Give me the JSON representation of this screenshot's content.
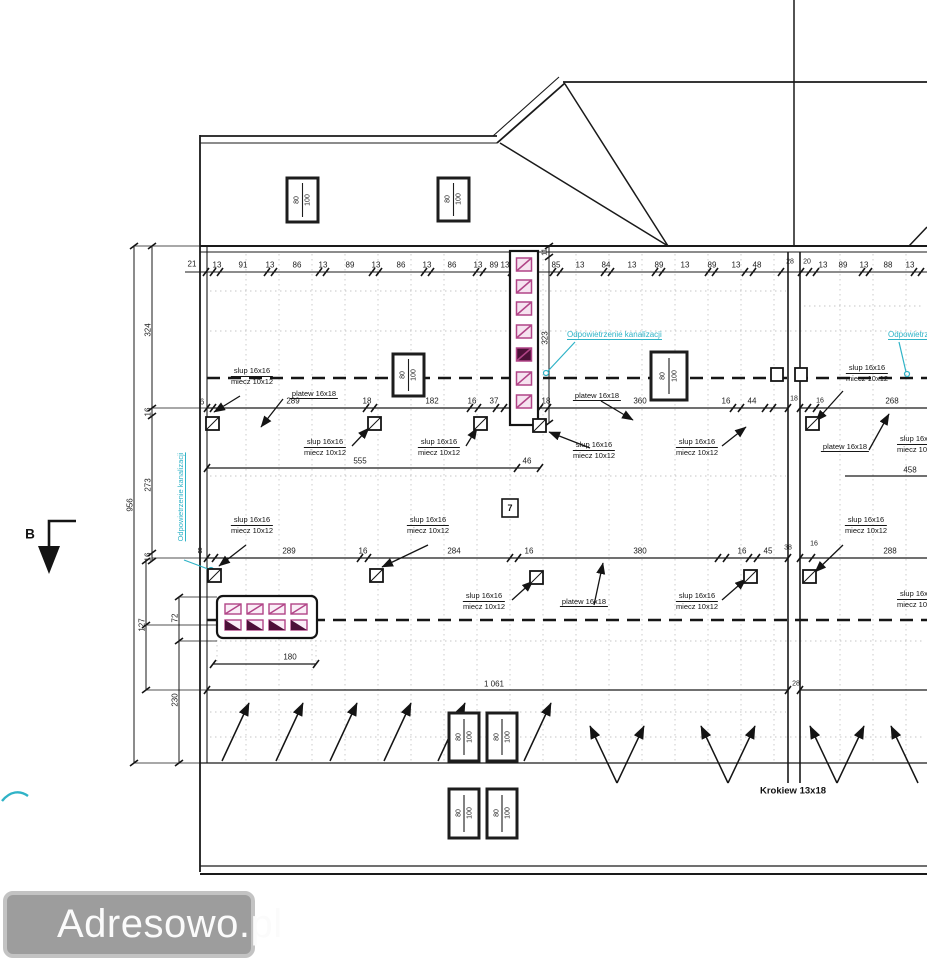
{
  "labels": {
    "slup": "slup 16x16",
    "miecz": "miecz 10x12",
    "platew": "platew 16x18",
    "krokiew": "Krokiew 13x18",
    "vent": "Odpowietrzenie kanalizacji",
    "win_top": "80",
    "win_bottom": "100",
    "detail_no": "7",
    "section": "B"
  },
  "dims": {
    "top": [
      "21",
      "13",
      "91",
      "13",
      "86",
      "13",
      "89",
      "13",
      "86",
      "13",
      "86",
      "13",
      "89",
      "13",
      "85",
      "13",
      "84",
      "13",
      "89",
      "13",
      "89",
      "13",
      "48",
      "28",
      "20",
      "13",
      "89",
      "13",
      "88",
      "13"
    ],
    "row1": [
      "6",
      "289",
      "18",
      "182",
      "16",
      "37",
      "18",
      "360",
      "16",
      "44",
      "18",
      "16",
      "268"
    ],
    "row2": [
      "8",
      "289",
      "16",
      "284",
      "16",
      "380",
      "16",
      "45",
      "38",
      "16",
      "288"
    ],
    "left": {
      "overall": "956",
      "chain": [
        "324",
        "16",
        "273",
        "16",
        "127"
      ],
      "inner": [
        "72",
        "230"
      ]
    },
    "chimney": {
      "h_top": "11",
      "h_side": "323",
      "w_main": "555",
      "w_small": "46"
    },
    "bottom": {
      "total": "1 061",
      "wall": "28",
      "box": "180",
      "right": "458"
    }
  },
  "watermark": {
    "text": "Adresowo.pl"
  },
  "colors": {
    "line": "#1a1a1a",
    "magenta": "#b14487",
    "magenta_fill": "#f6e3f0",
    "magenta_dark": "#4d1038",
    "cyan": "#2fb3c7"
  }
}
